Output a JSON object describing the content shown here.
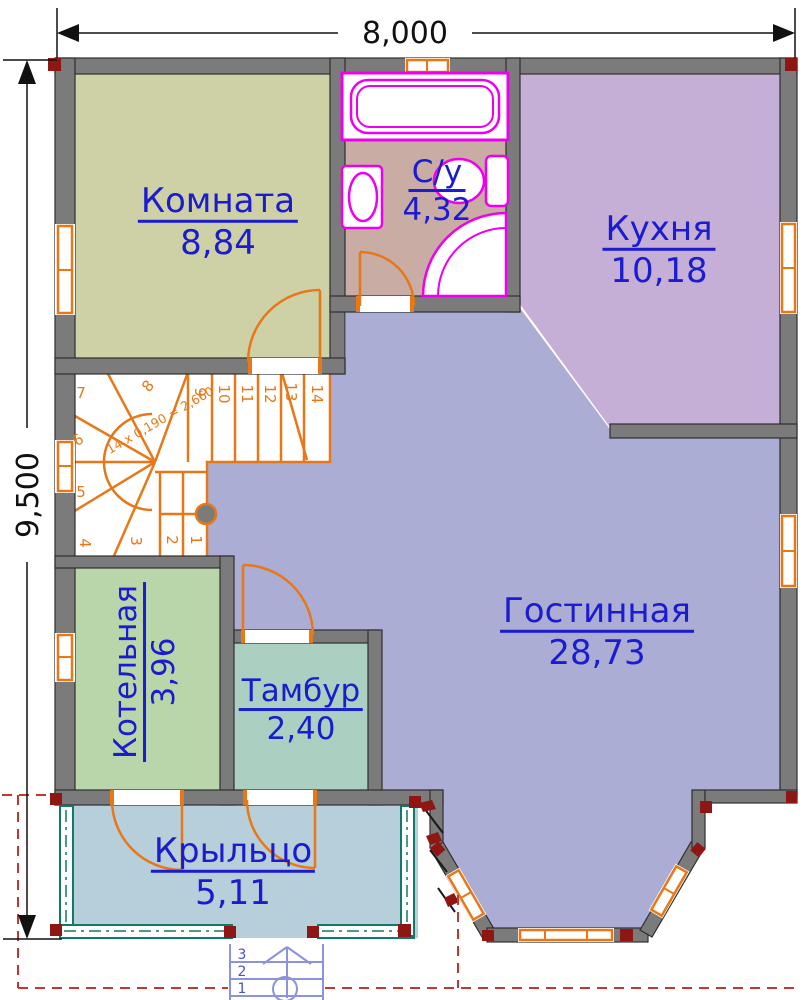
{
  "title": "floor-plan-first-floor",
  "dimensions": {
    "width_label": "8,000",
    "height_label": "9,500"
  },
  "rooms": [
    {
      "id": "komnata",
      "name": "Комната",
      "area": "8,84"
    },
    {
      "id": "su",
      "name": "С/у",
      "area": "4,32"
    },
    {
      "id": "kuhnya",
      "name": "Кухня",
      "area": "10,18"
    },
    {
      "id": "gostinnaya",
      "name": "Гостинная",
      "area": "28,73"
    },
    {
      "id": "kotelnaya",
      "name": "Котельная",
      "area": "3,96"
    },
    {
      "id": "tambur",
      "name": "Тамбур",
      "area": "2,40"
    },
    {
      "id": "krylco",
      "name": "Крыльцо",
      "area": "5,11"
    }
  ],
  "stairs": {
    "note": "14 x 0,190 = 2,660",
    "treads": [
      "1",
      "2",
      "3",
      "4",
      "5",
      "6",
      "7",
      "8",
      "9",
      "10",
      "11",
      "12",
      "13",
      "14"
    ]
  },
  "porch_steps": [
    "1",
    "2",
    "3"
  ],
  "colors": {
    "wall": "#7b7b7b",
    "wall_outline": "#2f2f2f",
    "door_window_orange": "#e87817",
    "fixture_magenta": "#ee00ee",
    "label_blue": "#1b1bd0",
    "dimension_black": "#111111",
    "roof_dashed_red": "#bf3a2b",
    "porch_rail_teal": "#10796a",
    "corner_mark_red": "#8f1713",
    "outdoor_steps_blue": "#8b93dc",
    "floor_komnata": "#cdd1a5",
    "floor_bathroom": "#c9aca4",
    "floor_kitchen": "#c6afd7",
    "floor_living": "#abadd5",
    "floor_kotelnaya": "#b9d6ab",
    "floor_tambur": "#abd0c1",
    "floor_porch": "#b6cfda"
  }
}
